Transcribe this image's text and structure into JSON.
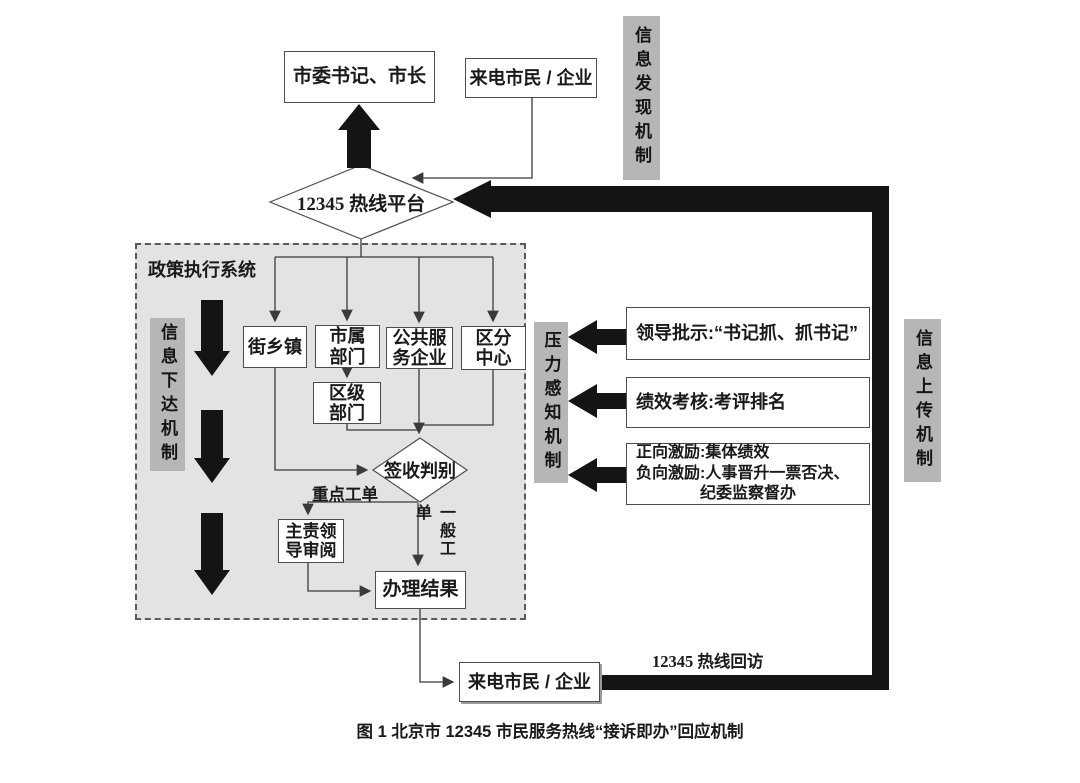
{
  "caption": "图 1 北京市 12345 市民服务热线“接诉即办”回应机制",
  "nodes": {
    "leaders": "市委书记、市长",
    "callers_top": "来电市民 / 企业",
    "hotline_platform": "12345 热线平台",
    "policy_system_label": "政策执行系统",
    "street_township": "街乡镇",
    "municipal_dept": "市属\n部门",
    "public_service_firm": "公共服\n务企业",
    "district_center": "区分\n中心",
    "district_dept": "区级\n部门",
    "sign_judge": "签收判别",
    "key_ticket_label": "重点工单",
    "general_ticket_label": "一般工单",
    "lead_review": "主责领\n导审阅",
    "handle_result": "办理结果",
    "callers_bottom": "来电市民 / 企业",
    "callback_label": "12345 热线回访"
  },
  "mechanisms": {
    "discovery": "信息发现机制",
    "dispatch": "信息下达机制",
    "pressure": "压力感知机制",
    "upload": "信息上传机制"
  },
  "pressure_items": {
    "leader_note": "领导批示:“书记抓、抓书记”",
    "performance_review": "绩效考核:考评排名",
    "incentives": "正向激励:集体绩效\n负向激励:人事晋升一票否决、\n　　　　纪委监察督办"
  },
  "colors": {
    "panel_fill": "#e3e3e3",
    "mechanism_label_fill": "#b6b6b6",
    "arrow_black": "#141414",
    "line_gray": "#3a3a3a",
    "box_border": "#4d4d4d"
  }
}
